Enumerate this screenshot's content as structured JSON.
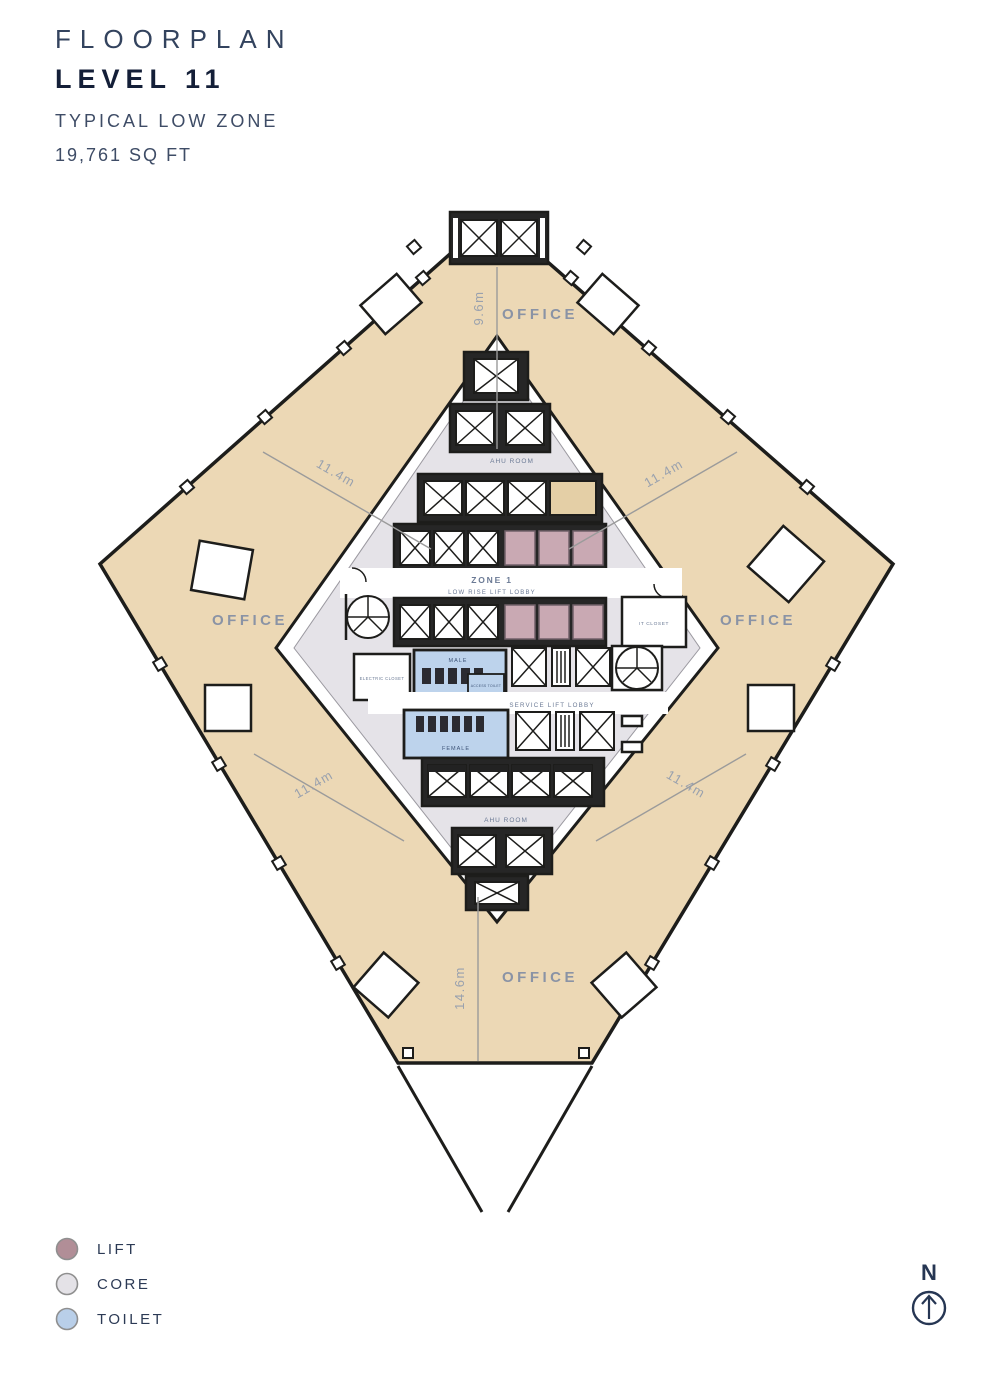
{
  "header": {
    "title": "FLOORPLAN",
    "level": "LEVEL 11",
    "subtitle": "TYPICAL LOW ZONE",
    "area": "19,761 SQ FT"
  },
  "plan": {
    "office_label": "OFFICE",
    "dimensions": {
      "top": "9.6m",
      "diagonal": "11.4m",
      "bottom": "14.6m"
    },
    "core": {
      "zone_title": "ZONE 1",
      "zone_subtitle": "LOW RISE LIFT LOBBY",
      "service_lobby": "SERVICE LIFT LOBBY",
      "ahu_room": "AHU ROOM",
      "it_closet": "IT CLOSET",
      "electric_closet": "ELECTRIC CLOSET",
      "male": "MALE",
      "female": "FEMALE",
      "access_toilet": "ACCESS TOILET"
    },
    "colors": {
      "office": "#ecd8b5",
      "core": "#e5e3e8",
      "lift": "#c9a9b3",
      "toilet": "#bdd3ec",
      "outline": "#1d1d1b"
    }
  },
  "legend": {
    "items": [
      {
        "label": "LIFT",
        "color": "#b18e97"
      },
      {
        "label": "CORE",
        "color": "#e4e2e7"
      },
      {
        "label": "TOILET",
        "color": "#b9cfe9"
      }
    ]
  },
  "compass": {
    "label": "N"
  }
}
